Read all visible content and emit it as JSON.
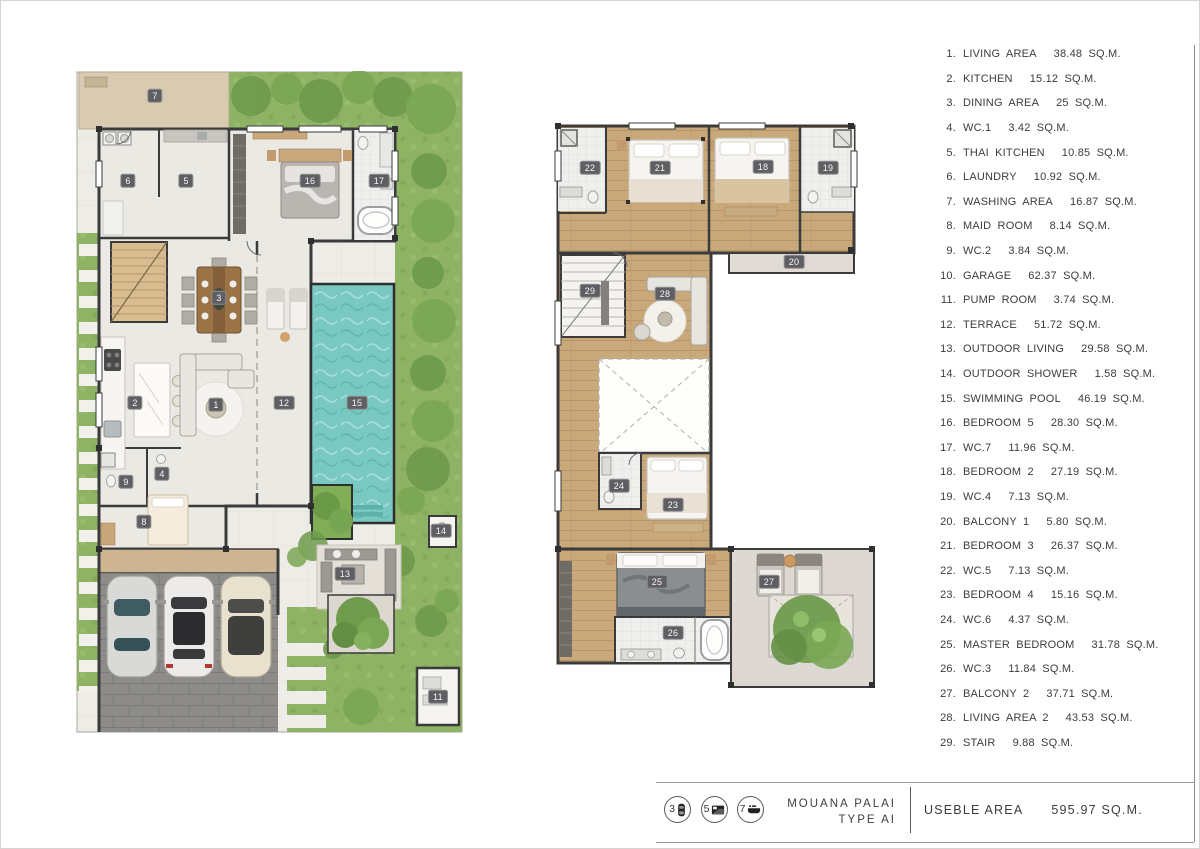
{
  "legend": {
    "items": [
      {
        "n": "1.",
        "name": "LIVING AREA",
        "area": "38.48 SQ.M."
      },
      {
        "n": "2.",
        "name": "KITCHEN",
        "area": "15.12 SQ.M."
      },
      {
        "n": "3.",
        "name": "DINING AREA",
        "area": "25 SQ.M."
      },
      {
        "n": "4.",
        "name": "WC.1",
        "area": "3.42 SQ.M."
      },
      {
        "n": "5.",
        "name": "THAI KITCHEN",
        "area": "10.85 SQ.M."
      },
      {
        "n": "6.",
        "name": "LAUNDRY",
        "area": "10.92 SQ.M."
      },
      {
        "n": "7.",
        "name": "WASHING AREA",
        "area": "16.87 SQ.M."
      },
      {
        "n": "8.",
        "name": "MAID ROOM",
        "area": "8.14 SQ.M."
      },
      {
        "n": "9.",
        "name": "WC.2",
        "area": "3.84 SQ.M."
      },
      {
        "n": "10.",
        "name": "GARAGE",
        "area": "62.37 SQ.M."
      },
      {
        "n": "11.",
        "name": "PUMP ROOM",
        "area": "3.74 SQ.M."
      },
      {
        "n": "12.",
        "name": "TERRACE",
        "area": "51.72 SQ.M."
      },
      {
        "n": "13.",
        "name": "OUTDOOR LIVING",
        "area": "29.58 SQ.M."
      },
      {
        "n": "14.",
        "name": "OUTDOOR SHOWER",
        "area": "1.58 SQ.M."
      },
      {
        "n": "15.",
        "name": "SWIMMING POOL",
        "area": "46.19 SQ.M."
      },
      {
        "n": "16.",
        "name": "BEDROOM 5",
        "area": "28.30 SQ.M."
      },
      {
        "n": "17.",
        "name": "WC.7",
        "area": "11.96 SQ.M."
      },
      {
        "n": "18.",
        "name": "BEDROOM 2",
        "area": "27.19 SQ.M."
      },
      {
        "n": "19.",
        "name": "WC.4",
        "area": "7.13 SQ.M."
      },
      {
        "n": "20.",
        "name": "BALCONY 1",
        "area": "5.80 SQ.M."
      },
      {
        "n": "21.",
        "name": "BEDROOM 3",
        "area": "26.37 SQ.M."
      },
      {
        "n": "22.",
        "name": "WC.5",
        "area": "7.13 SQ.M."
      },
      {
        "n": "23.",
        "name": "BEDROOM 4",
        "area": "15.16 SQ.M."
      },
      {
        "n": "24.",
        "name": "WC.6",
        "area": "4.37 SQ.M."
      },
      {
        "n": "25.",
        "name": "MASTER BEDROOM",
        "area": "31.78 SQ.M."
      },
      {
        "n": "26.",
        "name": "WC.3",
        "area": "11.84 SQ.M."
      },
      {
        "n": "27.",
        "name": "BALCONY 2",
        "area": "37.71 SQ.M."
      },
      {
        "n": "28.",
        "name": "LIVING AREA 2",
        "area": "43.53 SQ.M."
      },
      {
        "n": "29.",
        "name": "STAIR",
        "area": "9.88 SQ.M."
      }
    ]
  },
  "plans": {
    "ground_floor": {
      "labels": [
        {
          "n": "7",
          "x": 154,
          "y": 95
        },
        {
          "n": "6",
          "x": 127,
          "y": 180
        },
        {
          "n": "5",
          "x": 185,
          "y": 180
        },
        {
          "n": "16",
          "x": 309,
          "y": 180
        },
        {
          "n": "17",
          "x": 378,
          "y": 180
        },
        {
          "n": "3",
          "x": 218,
          "y": 297
        },
        {
          "n": "2",
          "x": 134,
          "y": 402
        },
        {
          "n": "1",
          "x": 215,
          "y": 404
        },
        {
          "n": "12",
          "x": 283,
          "y": 402
        },
        {
          "n": "15",
          "x": 356,
          "y": 402
        },
        {
          "n": "9",
          "x": 125,
          "y": 481
        },
        {
          "n": "4",
          "x": 161,
          "y": 473
        },
        {
          "n": "8",
          "x": 143,
          "y": 521
        },
        {
          "n": "14",
          "x": 440,
          "y": 530
        },
        {
          "n": "13",
          "x": 344,
          "y": 573
        },
        {
          "n": "11",
          "x": 437,
          "y": 696
        }
      ]
    },
    "second_floor": {
      "labels": [
        {
          "n": "22",
          "x": 589,
          "y": 167
        },
        {
          "n": "21",
          "x": 659,
          "y": 167
        },
        {
          "n": "18",
          "x": 762,
          "y": 166
        },
        {
          "n": "19",
          "x": 827,
          "y": 167
        },
        {
          "n": "20",
          "x": 793,
          "y": 261
        },
        {
          "n": "29",
          "x": 589,
          "y": 290
        },
        {
          "n": "28",
          "x": 664,
          "y": 293
        },
        {
          "n": "24",
          "x": 618,
          "y": 485
        },
        {
          "n": "23",
          "x": 672,
          "y": 504
        },
        {
          "n": "25",
          "x": 656,
          "y": 581
        },
        {
          "n": "26",
          "x": 672,
          "y": 632
        },
        {
          "n": "27",
          "x": 768,
          "y": 581
        }
      ]
    }
  },
  "footer": {
    "stats": [
      {
        "count": "3",
        "icon": "car-icon"
      },
      {
        "count": "5",
        "icon": "bed-icon"
      },
      {
        "count": "7",
        "icon": "bath-icon"
      }
    ],
    "project_line1": "MOUANA PALAI",
    "project_line2": "TYPE AI",
    "useble_label": "USEBLE AREA",
    "useble_value": "595.97 SQ.M."
  },
  "colors": {
    "pool": "#79c9c2",
    "garden": "#8fb364",
    "wood_floor": "#c9a87a",
    "wall": "#3b3b3b",
    "stone_floor": "#eeece6",
    "pavement": "#8d8c8a",
    "badge": "#5f5f63"
  }
}
